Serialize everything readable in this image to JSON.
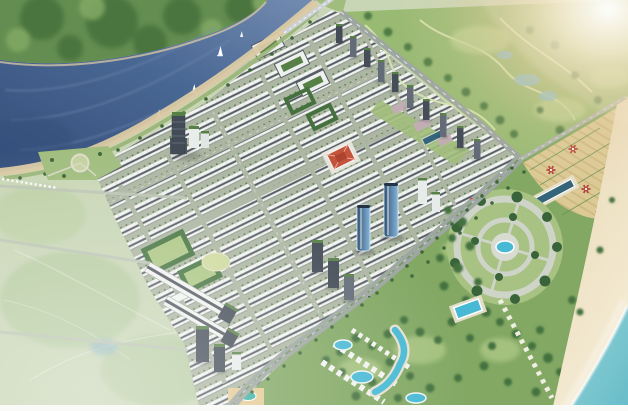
{
  "scene": {
    "type": "aerial-architectural-rendering",
    "subject": "coastal master-planned urban development, bird's-eye view",
    "regions": [
      "forest-hills",
      "river",
      "riverside-promenade",
      "city-rowhouse-grid",
      "golf-park",
      "coastal-avenue",
      "beach-resort",
      "tan-garden-field",
      "circular-plaza",
      "beach",
      "sea",
      "sun-flare"
    ],
    "counts": {
      "sailboats": 4,
      "glass_towers": 2,
      "red_garden_features": 6,
      "golf_ponds": 4,
      "resort_pools": 5,
      "roadside_towers": 10
    }
  },
  "palette": {
    "land": "#c6d4b2",
    "hills_base": "#5c8748",
    "hills_dark": "#3e6a33",
    "hills_light": "#7aa45c",
    "river_deep": "#2c4674",
    "river_mid": "#40608f",
    "river_light": "#6c86ad",
    "river_sand": "#d9c7a0",
    "lawn": "#8fae6a",
    "park_green": "#9cba78",
    "tree_dark": "#35602f",
    "city_street": "#a9b39f",
    "building_white": "#f1f3f0",
    "window_stripe": "#4b525a",
    "row_shadow": "#8d968b",
    "street_tree": "#4c7440",
    "campus_green": "#3f6f38",
    "campus_lawn": "#a9c57f",
    "red_roof": "#c04a31",
    "red_roof_dark": "#a93a26",
    "tower_dark": "#39424d",
    "tower_mid": "#5a6470",
    "tower_white": "#e6eae8",
    "tower_cap_green": "#4e7a3e",
    "glass_dark": "#27486b",
    "glass_light": "#7fb2d8",
    "road_gray": "#98a29c",
    "road_line": "#f4f6f2",
    "median_green": "#6d8f57",
    "golf_green": "#93b76c",
    "golf_path": "#d7e4ae",
    "golf_light": "#b9d28e",
    "pond_blue": "#84bac6",
    "resort_green": "#7ca45c",
    "pool_teal": "#3fb6d2",
    "pool_deep": "#2b5d74",
    "deck_tan": "#e6dfc9",
    "plaza_gray": "#ccd2c6",
    "plaza_hub": "#d6dad0",
    "mauve_plaza": "#c2a9b4",
    "field_tan": "#dbc891",
    "field_stripe": "#cdb87c",
    "hedge_green": "#5d8a48",
    "flower_red": "#b23a32",
    "sand": "#e8d7b0",
    "sand_light": "#f4ead2",
    "sea": "#8ed0d6",
    "sea_deep": "#5fb9c6",
    "foam": "#ffffff",
    "flare_warm": "#ecd3a6",
    "boat_white": "#ffffff",
    "border_white": "#fafaf8"
  }
}
